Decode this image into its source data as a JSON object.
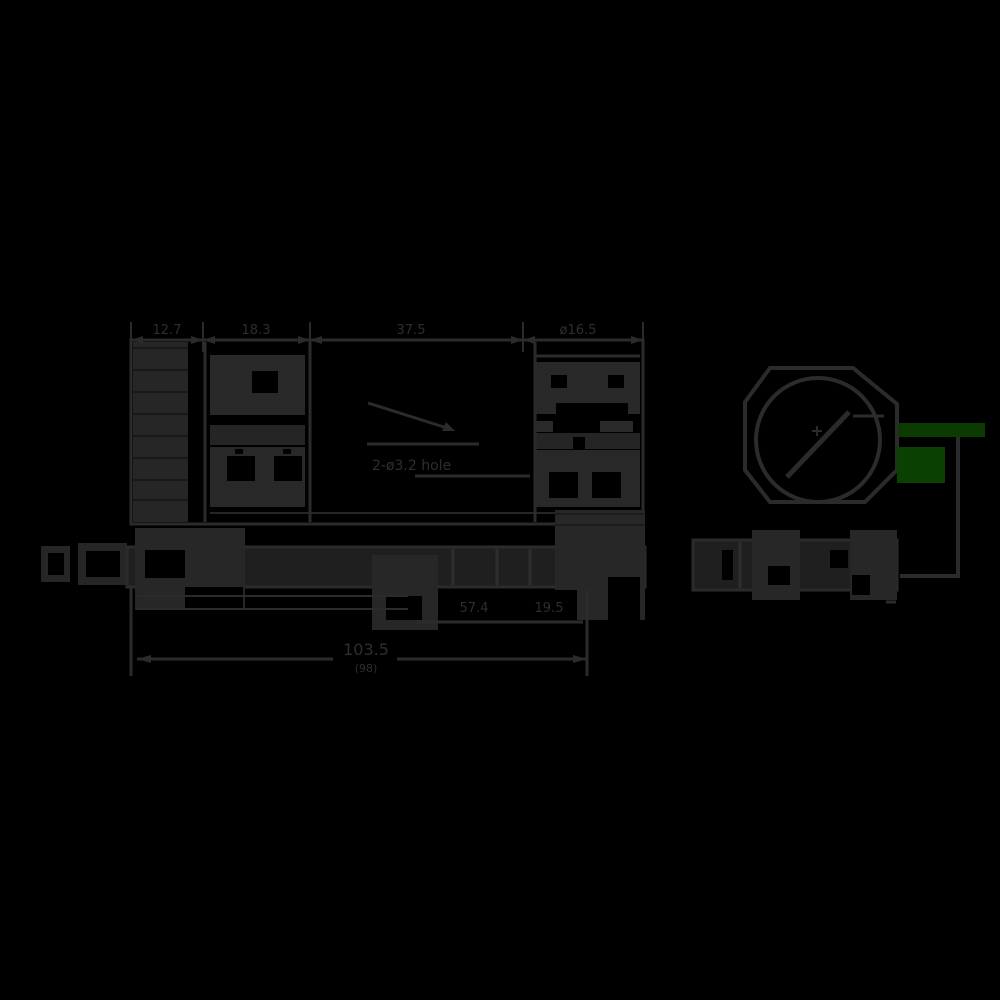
{
  "drawing": {
    "type": "technical-dimension-drawing",
    "appearance": "black line art rendered on black background (ghosted dark-gray lines)",
    "background_color": "#000000",
    "line_color": "#2b2b2b",
    "fill_color": "#272727",
    "views": {
      "top_view": "rectangular body with ribbed connector strip and two terminal modules",
      "side_view": "long thin profile with cable end, mounting brackets and foot",
      "front_view": "octagonal face with circular lens and diagonal slash",
      "front_side_view": "short profile bar under front view"
    },
    "dimensions": {
      "top": [
        "12.7",
        "18.3",
        "37.5",
        "ø16.5"
      ],
      "middle": [
        "57.4",
        "19.5"
      ],
      "overall": "103.5",
      "overall_sub": "(98)",
      "callout": "2-ø3.2 hole"
    },
    "annotation": {
      "green_bar_color": "#0c3b02",
      "green_block_color": "#0a4101",
      "description": "green highlighted indicator marks beside front view with leader line"
    }
  }
}
